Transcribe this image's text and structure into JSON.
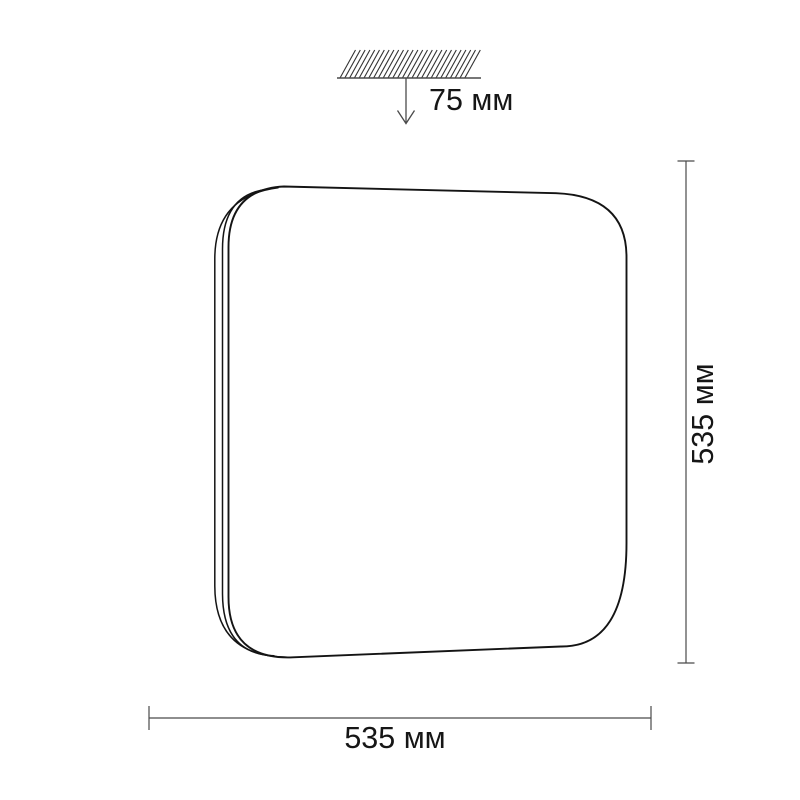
{
  "drawing": {
    "background": "#ffffff",
    "outline_color": "#141414",
    "dimension_color": "#4a4a4a",
    "hatch_color": "#333333",
    "text_color": "#161616",
    "labels": {
      "mount_depth": "75 мм",
      "height": "535 мм",
      "width": "535 мм"
    }
  }
}
